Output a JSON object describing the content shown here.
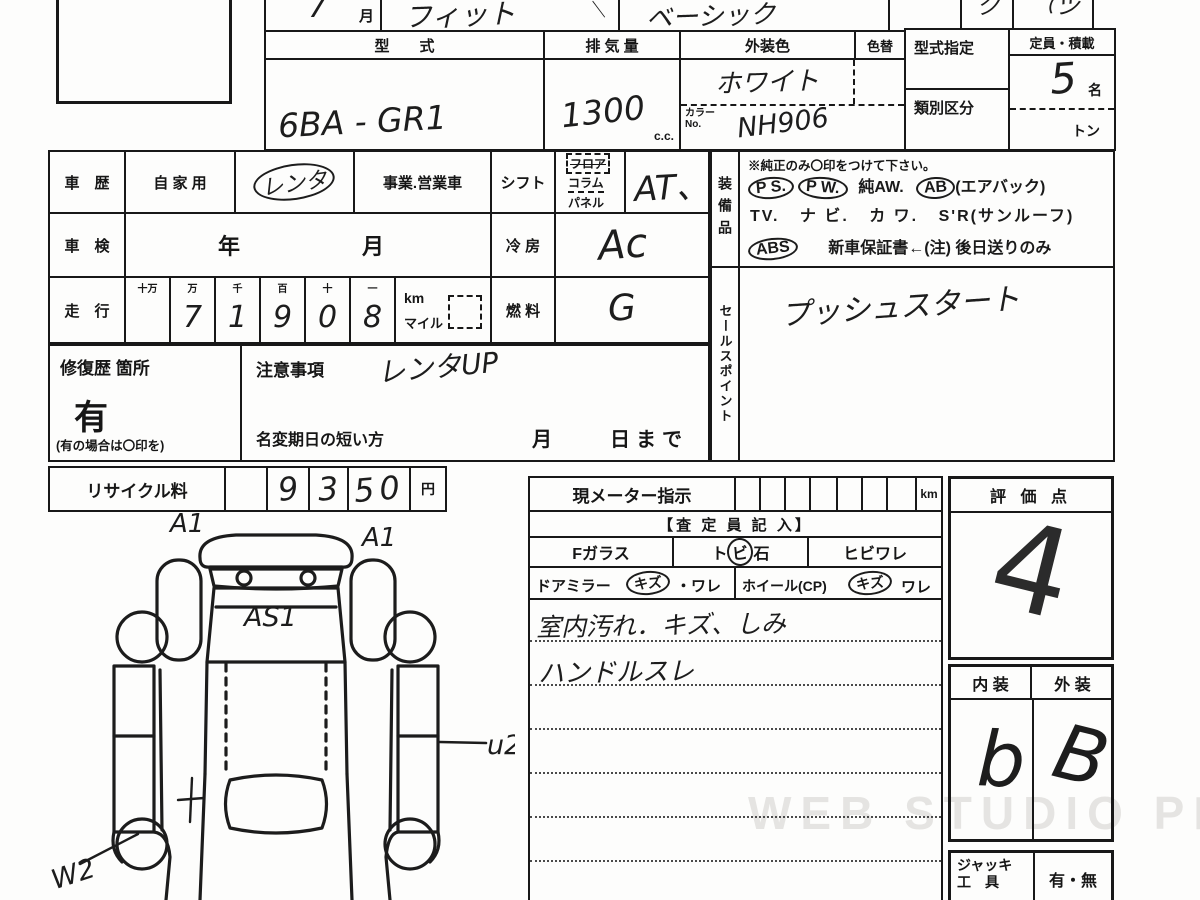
{
  "watermark": "WEB STUDIO PRO",
  "lot": {
    "number": "7001"
  },
  "top_row": {
    "month_hw": "7",
    "month_label": "月",
    "name_hw": "フィット",
    "stray_tick": "＼",
    "grade_hw": "ベーシック",
    "corner_hw_1": "ク",
    "corner_hw_2": "（ヅ"
  },
  "spec": {
    "model_label": "型　　式",
    "model_value": "6BA - GR1",
    "disp_label": "排 気 量",
    "disp_value": "1300",
    "disp_unit": "c.c.",
    "color_label": "外装色",
    "color_change_label": "色替",
    "color_value": "ホワイト",
    "color_no_label": "カラー",
    "color_no_sub": "No.",
    "color_no_value": "NH906",
    "type_desig_label": "型式指定",
    "class_label": "類別区分",
    "capacity_label": "定員・積載",
    "capacity_value": "5",
    "capacity_unit": "名",
    "ton_label": "トン"
  },
  "history": {
    "label": "車　歴",
    "private": "自 家 用",
    "hw": "レンタ",
    "business": "事業.営業車"
  },
  "shaken": {
    "label": "車　検",
    "value": "年　　　月"
  },
  "mileage": {
    "label": "走　行",
    "headers": [
      "十万",
      "万",
      "千",
      "百",
      "十",
      "一"
    ],
    "digits": [
      "",
      "7",
      "1",
      "9",
      "0",
      "8"
    ],
    "km": "km",
    "mile": "マイル"
  },
  "shift": {
    "label": "シフト",
    "opt1": "フロア",
    "opt2": "コラム",
    "opt3": "パネル",
    "value": "AT、"
  },
  "cooling": {
    "label": "冷 房",
    "value": "Ac"
  },
  "fuel": {
    "label": "燃 料",
    "value": "G"
  },
  "equipment": {
    "label": "装備品",
    "note": "※純正のみ〇印をつけて下さい。",
    "ps": "P S.",
    "pw": "P W.",
    "aw": "純AW.",
    "ab": "AB",
    "ab_note": "(エアバック)",
    "tv": "TV.",
    "navi": "ナ ビ.",
    "kawa": "カ ワ.",
    "sr": "S'R(サンルーフ)",
    "abs": "ABS",
    "warranty": "新車保証書←(注) 後日送りのみ"
  },
  "sales_point": {
    "label": "セールスポイント",
    "hw": "プッシュスタート"
  },
  "repair": {
    "label": "修復歴 箇所",
    "value": "有",
    "note": "(有の場合は〇印を)"
  },
  "caution": {
    "label": "注意事項",
    "hw": "レンタUP"
  },
  "name_change": {
    "label": "名変期日の短い方",
    "suffix": "月　　日まで"
  },
  "recycle": {
    "label": "リサイクル料",
    "d1": "9",
    "d2": "3",
    "d3": "50",
    "unit": "円"
  },
  "meter": {
    "label": "現メーター指示",
    "unit": "km"
  },
  "assessor": {
    "header": "【査 定 員 記 入】",
    "fglass": "Fガラス",
    "tobi_pre": "ト",
    "tobi_mid": "ビ",
    "tobi_post": "石",
    "hibiware": "ヒビワレ",
    "mirror": "ドアミラー",
    "mirror_kizu": "キズ",
    "mirror_ware": "・ワレ",
    "wheel": "ホイール(CP)",
    "wheel_kizu": "キズ",
    "wheel_ware": "ワレ",
    "note1": "室内汚れ．キズ、しみ",
    "note2": "ハンドルスレ"
  },
  "score": {
    "label": "評 価 点",
    "value": "4"
  },
  "grade_box": {
    "interior_label": "内 装",
    "exterior_label": "外 装",
    "interior_value": "b",
    "exterior_value": "B"
  },
  "jack": {
    "label_line1": "ジャッキ",
    "label_line2": "工　具",
    "value": "有・無"
  },
  "diagram": {
    "a1_left": "A1",
    "a1_right": "A1",
    "as1": "AS1",
    "u2": "u2",
    "w2": "W2"
  }
}
